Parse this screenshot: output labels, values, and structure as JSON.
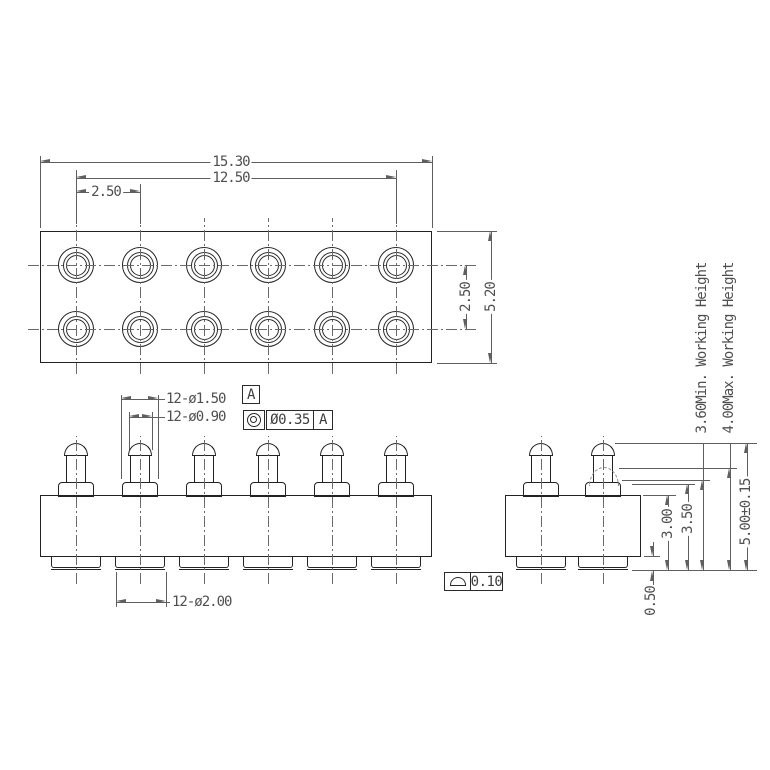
{
  "top_view": {
    "columns": 6,
    "rows": 2,
    "hole_count": 12,
    "dim_total_width": "15.30",
    "dim_pin_span": "12.50",
    "dim_col_pitch": "2.50",
    "dim_row_pitch": "2.50",
    "dim_total_depth": "5.20"
  },
  "callouts": {
    "flange_dia": {
      "text": "12-ø1.50",
      "datum": "A"
    },
    "plunger_dia": {
      "text": "12-ø0.90",
      "fcf_tolerance": "Ø0.35",
      "fcf_datum": "A"
    },
    "tail_dia": {
      "text": "12-ø2.00"
    },
    "surface_profile": {
      "tolerance": "0.10"
    }
  },
  "side_view": {
    "dim_body_plus_tail": "3.00",
    "dim_flange_to_tail": "3.50",
    "dim_total_height": "5.00±0.15",
    "dim_tail_height": "0.50",
    "working_height_min": "3.60Min. Working Height",
    "working_height_max": "4.00Max. Working Height"
  },
  "icons": {
    "concentricity": "double concentric circle (bullseye) GD&T symbol",
    "profile_of_surface": "half-disc GD&T profile of a surface symbol"
  },
  "colors": {
    "background": "#ffffff",
    "object_line": "#222222",
    "dimension_line": "#5f5f5f",
    "text": "#4a4a4a"
  }
}
